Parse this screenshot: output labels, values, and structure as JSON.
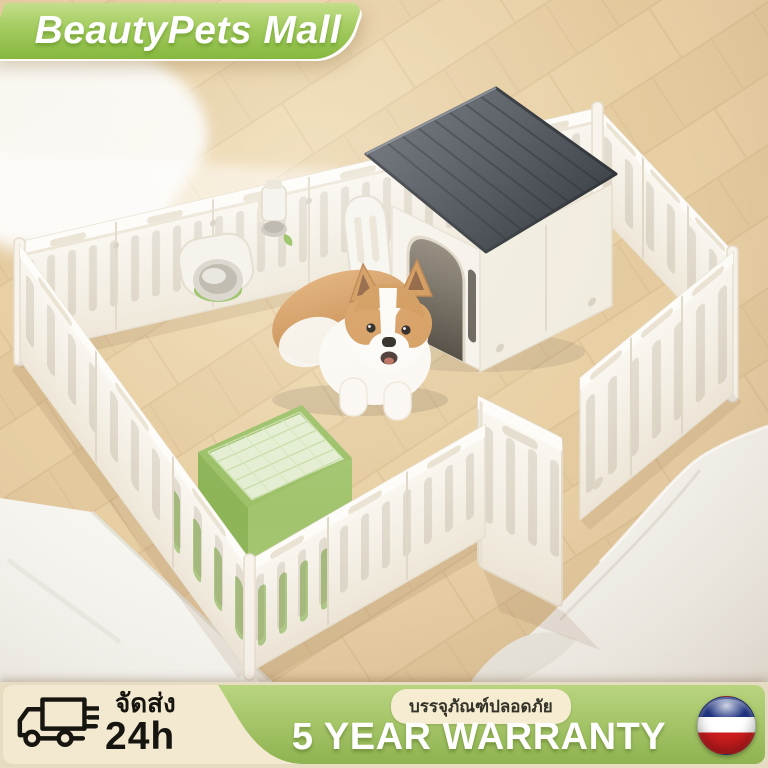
{
  "brand": "BeautyPets Mall",
  "shipping": {
    "label": "จัดส่ง",
    "time": "24h",
    "icon": "truck-icon"
  },
  "warranty": {
    "packaging_badge": "บรรจุภัณฑ์ปลอดภัย",
    "label": "5 YEAR WARRANTY",
    "flag_icon": "flag-roundel-icon"
  },
  "colors": {
    "badge_green": "#9cc653",
    "banner_green": "#a4c46a",
    "banner_cream": "#f2e9d0",
    "roof_gray": "#3f444b",
    "litter_green": "#9cc168",
    "fence_white": "#f7f4ed",
    "floor_wood": "#e6cda1",
    "flag_blue": "#1e3380",
    "flag_red": "#cf1d1f"
  },
  "scene": {
    "subject": "corgi-dog-inside-white-plastic-playpen-on-wood-floor",
    "items": [
      "playpen-fence",
      "dog-house",
      "corgi-dog",
      "litter-tray",
      "food-bowl",
      "water-bottle",
      "open-gate-door",
      "sofa",
      "rug"
    ]
  }
}
